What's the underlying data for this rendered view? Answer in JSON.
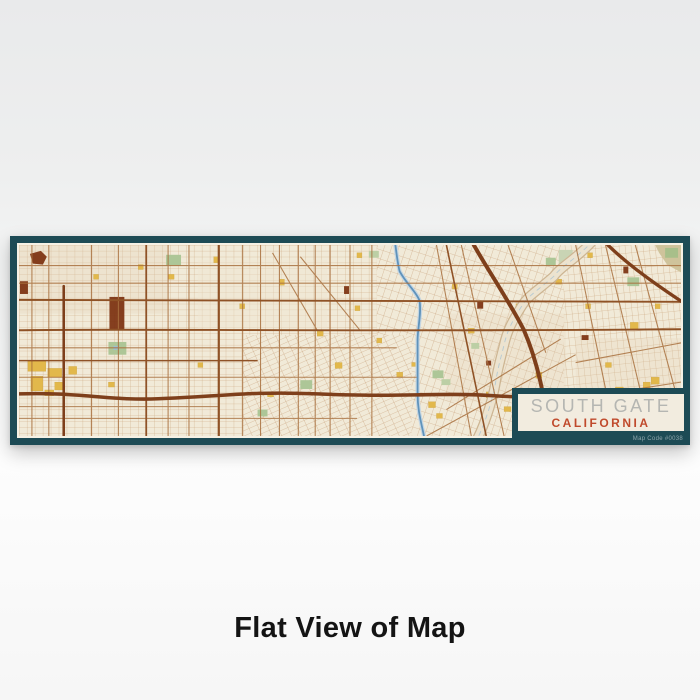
{
  "caption": "Flat View of Map",
  "print": {
    "title": "SOUTH GATE",
    "subtitle": "CALIFORNIA",
    "map_code": "Map Code #0038",
    "colors": {
      "frame_teal": "#1d4b55",
      "paper_cream": "#f1ead8",
      "label_background": "#f2ecdf",
      "title_gray": "#b5b6b2",
      "subtitle_orange": "#c04a2c",
      "street_minor": "#c9a178",
      "street_arterial": "#a9713f",
      "road_major": "#8f5226",
      "freeway_brown": "#7e3f1b",
      "river_blue": "#5f93bb",
      "wash_beige": "#ece3cf",
      "park_green": "#adc697",
      "landmark_yellow": "#e2b84b",
      "landmark_dark_brown": "#7c3110"
    }
  }
}
